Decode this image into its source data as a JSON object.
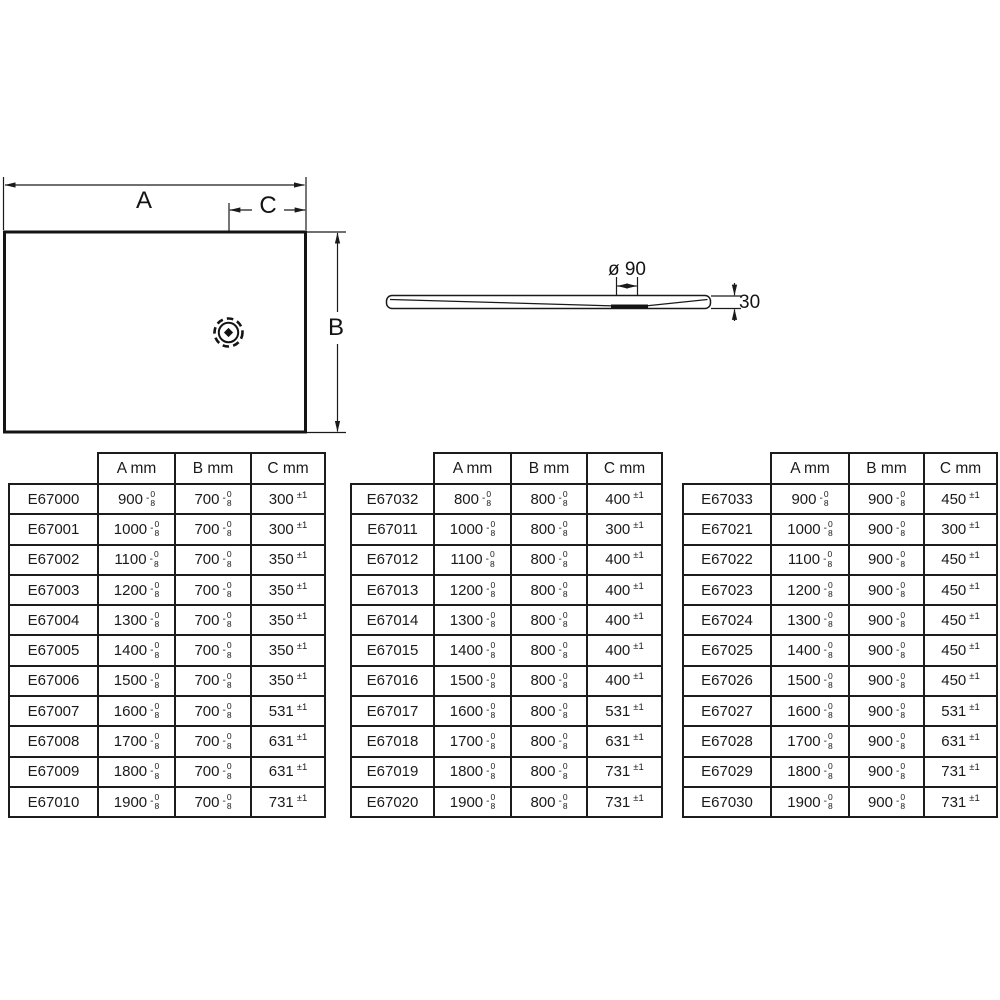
{
  "page": {
    "background": "#ffffff",
    "ink": "#1a1a1a"
  },
  "diagram": {
    "plan_view": {
      "width_label": "A",
      "height_label": "B",
      "drain_offset_label": "C"
    },
    "side_view": {
      "drain_diameter_label": "ø 90",
      "thickness_label": "30"
    }
  },
  "tolerances": {
    "dimension_sign": "-",
    "dimension_upper": "0",
    "dimension_lower": "8",
    "c_tolerance": "±1"
  },
  "tables": [
    {
      "headers": [
        "A mm",
        "B mm",
        "C mm"
      ],
      "rows": [
        [
          "E67000",
          "900",
          "700",
          "300"
        ],
        [
          "E67001",
          "1000",
          "700",
          "300"
        ],
        [
          "E67002",
          "1100",
          "700",
          "350"
        ],
        [
          "E67003",
          "1200",
          "700",
          "350"
        ],
        [
          "E67004",
          "1300",
          "700",
          "350"
        ],
        [
          "E67005",
          "1400",
          "700",
          "350"
        ],
        [
          "E67006",
          "1500",
          "700",
          "350"
        ],
        [
          "E67007",
          "1600",
          "700",
          "531"
        ],
        [
          "E67008",
          "1700",
          "700",
          "631"
        ],
        [
          "E67009",
          "1800",
          "700",
          "631"
        ],
        [
          "E67010",
          "1900",
          "700",
          "731"
        ]
      ]
    },
    {
      "headers": [
        "A mm",
        "B mm",
        "C mm"
      ],
      "rows": [
        [
          "E67032",
          "800",
          "800",
          "400"
        ],
        [
          "E67011",
          "1000",
          "800",
          "300"
        ],
        [
          "E67012",
          "1100",
          "800",
          "400"
        ],
        [
          "E67013",
          "1200",
          "800",
          "400"
        ],
        [
          "E67014",
          "1300",
          "800",
          "400"
        ],
        [
          "E67015",
          "1400",
          "800",
          "400"
        ],
        [
          "E67016",
          "1500",
          "800",
          "400"
        ],
        [
          "E67017",
          "1600",
          "800",
          "531"
        ],
        [
          "E67018",
          "1700",
          "800",
          "631"
        ],
        [
          "E67019",
          "1800",
          "800",
          "731"
        ],
        [
          "E67020",
          "1900",
          "800",
          "731"
        ]
      ]
    },
    {
      "headers": [
        "A mm",
        "B mm",
        "C mm"
      ],
      "rows": [
        [
          "E67033",
          "900",
          "900",
          "450"
        ],
        [
          "E67021",
          "1000",
          "900",
          "300"
        ],
        [
          "E67022",
          "1100",
          "900",
          "450"
        ],
        [
          "E67023",
          "1200",
          "900",
          "450"
        ],
        [
          "E67024",
          "1300",
          "900",
          "450"
        ],
        [
          "E67025",
          "1400",
          "900",
          "450"
        ],
        [
          "E67026",
          "1500",
          "900",
          "450"
        ],
        [
          "E67027",
          "1600",
          "900",
          "531"
        ],
        [
          "E67028",
          "1700",
          "900",
          "631"
        ],
        [
          "E67029",
          "1800",
          "900",
          "731"
        ],
        [
          "E67030",
          "1900",
          "900",
          "731"
        ]
      ]
    }
  ]
}
